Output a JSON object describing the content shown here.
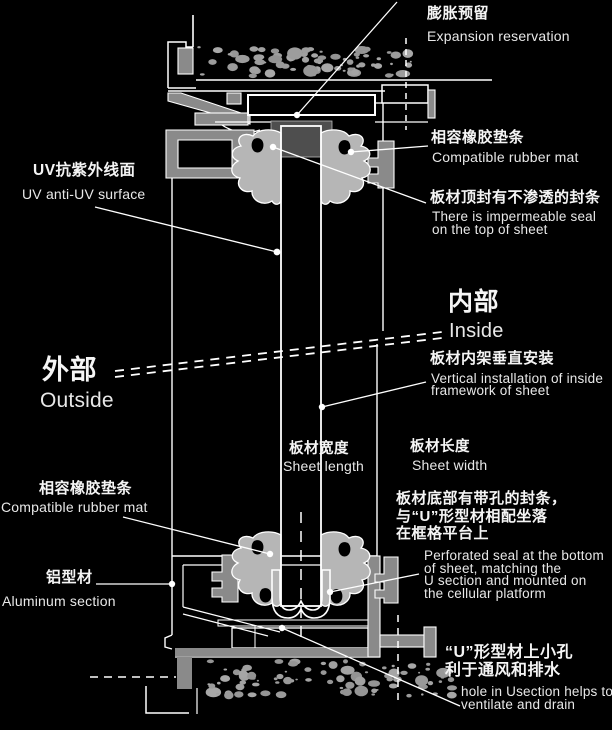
{
  "colors": {
    "background": "#000000",
    "line": "#ffffff",
    "profile_gray": "#8a8a8a",
    "gasket_gray": "#b6b6b6",
    "concrete_dot": "#9b9b9b",
    "sheet_fill": "#181818",
    "holder_gray": "#4e4e4e",
    "text_cn": "#f5f5f5",
    "text_en": "#e8e8e8"
  },
  "annotations": {
    "expansion": {
      "cn": "膨胀预留",
      "en": "Expansion reservation"
    },
    "rubber_mat_top": {
      "cn": "相容橡胶垫条",
      "en": "Compatible rubber mat"
    },
    "top_seal": {
      "cn": "板材顶封有不渗透的封条",
      "en1": "There is impermeable seal",
      "en2": "on the top of sheet"
    },
    "uv_surface": {
      "cn": "UV抗紫外线面",
      "en": "UV anti-UV surface"
    },
    "inside": {
      "cn": "内部",
      "en": "Inside"
    },
    "outside": {
      "cn": "外部",
      "en": "Outside"
    },
    "vertical_installation": {
      "cn": "板材内架垂直安装",
      "en1": "Vertical installation of inside",
      "en2": "framework of sheet"
    },
    "sheet_length": {
      "cn": "板材宽度",
      "en": "Sheet length"
    },
    "sheet_width": {
      "cn": "板材长度",
      "en": "Sheet width"
    },
    "rubber_mat_bottom": {
      "cn": "相容橡胶垫条",
      "en": "Compatible rubber mat"
    },
    "bottom_seal": {
      "cn1": "板材底部有带孔的封条，",
      "cn2": "与“U”形型材相配坐落",
      "cn3": "在框格平台上",
      "en1": "Perforated seal at the bottom",
      "en2": "of sheet, matching the",
      "en3": "U section and mounted on",
      "en4": "the cellular platform"
    },
    "aluminum": {
      "cn": "铝型材",
      "en": "Aluminum section"
    },
    "u_hole": {
      "cn1": "“U”形型材上小孔",
      "cn2": "利于通风和排水",
      "en1": "hole in Usection helps to",
      "en2": "ventilate and drain"
    }
  }
}
